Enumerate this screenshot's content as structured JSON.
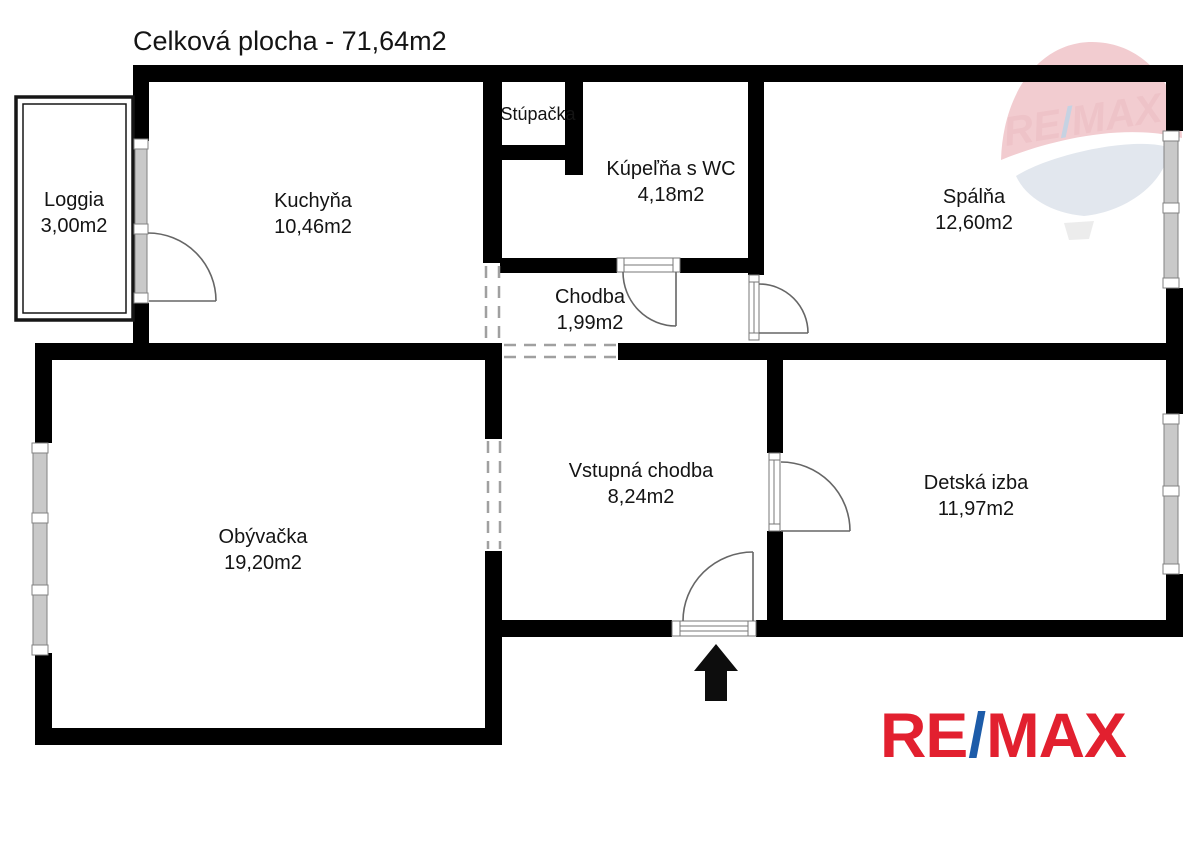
{
  "title": "Celková plocha - 71,64m2",
  "rooms": {
    "loggia": {
      "name": "Loggia",
      "area": "3,00m2"
    },
    "kuchyna": {
      "name": "Kuchyňa",
      "area": "10,46m2"
    },
    "stupacka": {
      "name": "Stúpačka"
    },
    "kupelna": {
      "name": "Kúpeľňa s WC",
      "area": "4,18m2"
    },
    "spalna": {
      "name": "Spálňa",
      "area": "12,60m2"
    },
    "chodba": {
      "name": "Chodba",
      "area": "1,99m2"
    },
    "vstupna": {
      "name": "Vstupná chodba",
      "area": "8,24m2"
    },
    "obyvacka": {
      "name": "Obývačka",
      "area": "19,20m2"
    },
    "detska": {
      "name": "Detská izba",
      "area": "11,97m2"
    }
  },
  "branding": {
    "logo_re": "RE",
    "logo_slash": "/",
    "logo_max": "MAX",
    "watermark_re": "RE",
    "watermark_slash": "/",
    "watermark_max": "MAX"
  },
  "colors": {
    "wall": "#000000",
    "remax_red": "#e2202f",
    "remax_blue": "#1d5ca9",
    "watermark_dome_pink": "#f2ccd0",
    "watermark_fan_gray": "#e2e7ee",
    "watermark_text_red": "#eec3c8",
    "watermark_slash_blue": "#c6d2e2"
  }
}
